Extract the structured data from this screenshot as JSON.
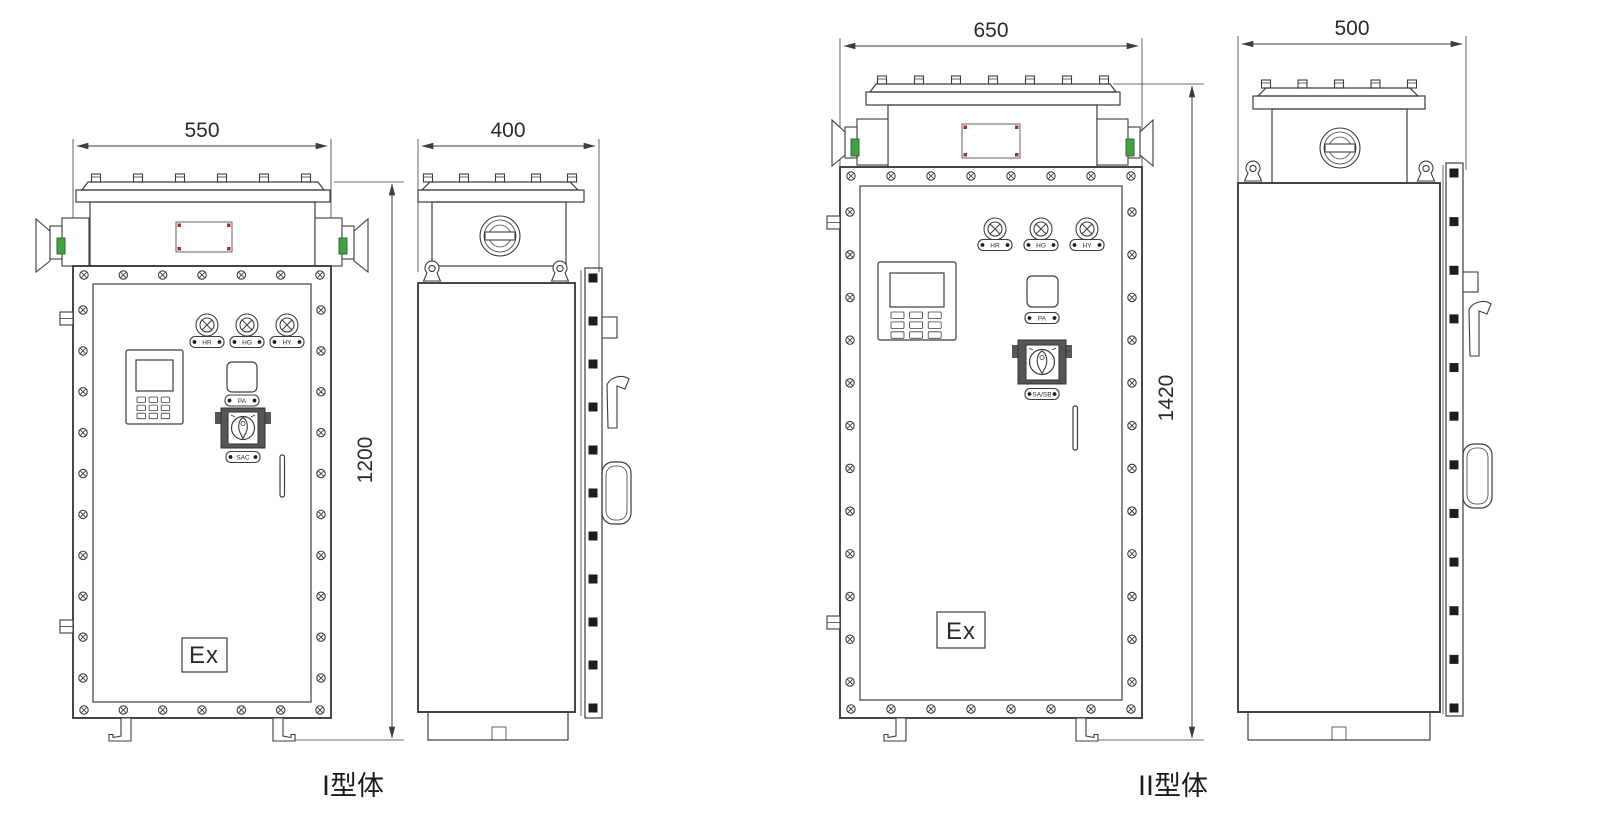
{
  "drawing": {
    "colors": {
      "line": "#3d3d3d",
      "red": "#a03232",
      "green": "#45a045",
      "dark": "#1d1d1d"
    },
    "views": {
      "type1_front": {
        "width_dim": "550",
        "height_dim": "1200"
      },
      "type1_side": {
        "width_dim": "400"
      },
      "type2_front": {
        "width_dim": "650",
        "height_dim": "1420"
      },
      "type2_side": {
        "width_dim": "500"
      }
    },
    "panel": {
      "indicator_labels": [
        "HR",
        "HG",
        "HY"
      ],
      "button_label": "PA",
      "type1_switch_label": "SAC",
      "type2_switch_label": "SA/SB",
      "ex_label": "Ex"
    },
    "captions": {
      "type1": "I型体",
      "type2": "II型体"
    }
  }
}
